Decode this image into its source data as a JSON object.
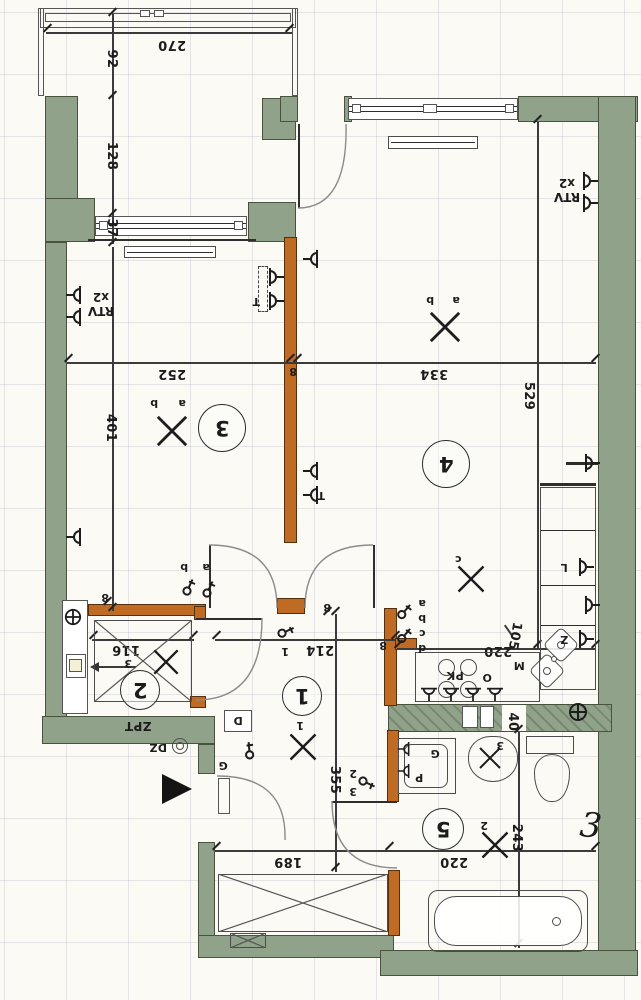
{
  "rooms": {
    "r1": "1",
    "r2": "2",
    "r3": "3",
    "r4": "4",
    "r5": "5"
  },
  "dims": {
    "balcony_w": "270",
    "balcony_a": "92",
    "balcony_b": "128",
    "balcony_c": "37",
    "room3_w": "252",
    "room3_l": "401",
    "room4_w": "334",
    "room4_l": "529",
    "wall8_a": "8",
    "wall8_b": "8",
    "wall8_c": "8",
    "wall8_d": "8",
    "room2_w": "116",
    "hall_w": "214",
    "hall_w_extra": "1",
    "hall_l": "355",
    "entry_w": "189",
    "bath_w": "220",
    "bath_l": "243",
    "kitchen_w": "220",
    "kitchen_pass": "105",
    "kitchen_niche": "40",
    "vent_ref": "3"
  },
  "labels": {
    "rtv_left_line1": "RTV",
    "rtv_left_line2": "x2",
    "rtv_right_line1": "RTV",
    "rtv_right_line2": "x2",
    "socket_t_room3": "T",
    "socket_t_room4": "T",
    "fridge": "L",
    "sink_socket": "Z",
    "hob": "PK",
    "oven": "O",
    "hood": "M",
    "panel": "ZPT",
    "doorbell": "DZ",
    "intercom": "D",
    "entry_socket": "G",
    "washer": "P",
    "washer_socket": "G",
    "lamp_room3_a": "a",
    "lamp_room3_b": "b",
    "lamp_room4_a": "a",
    "lamp_room4_b": "b",
    "lamp_kitchen": "c",
    "lamp_hall": "1",
    "lamp_bath": "2",
    "lamp_basin": "3",
    "switch_a": "a",
    "switch_b": "b",
    "switch_c": "c",
    "switch_d": "d",
    "switch_room3_a": "a",
    "switch_room3_b": "b",
    "switch_bath_2": "2",
    "switch_bath_3": "3",
    "handwritten_note": "3"
  }
}
